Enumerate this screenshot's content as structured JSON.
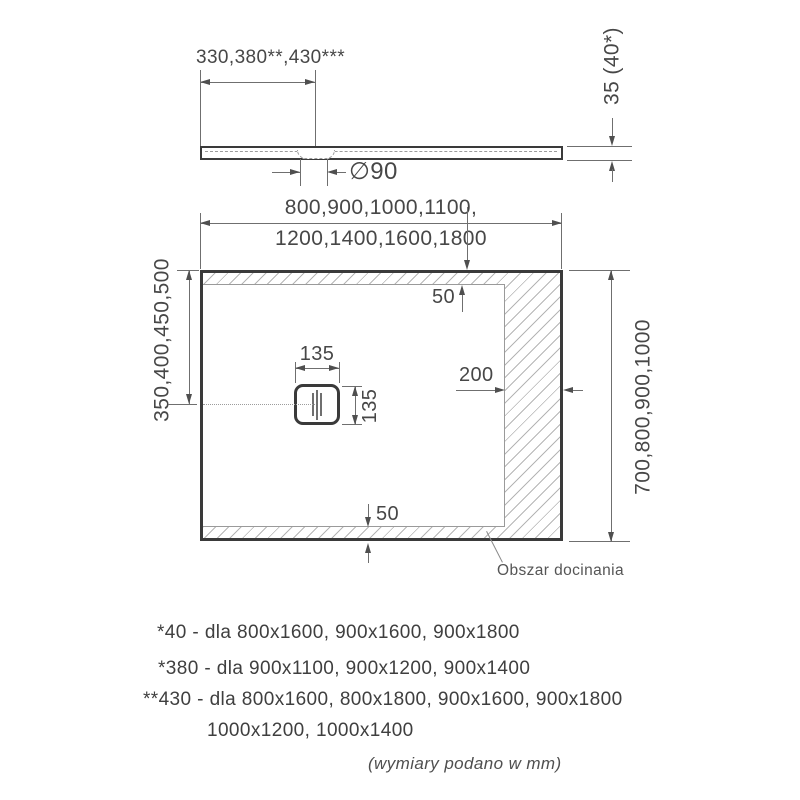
{
  "side_view": {
    "drain_offset_label": "330,380**,430***",
    "drain_diameter_label": "∅90",
    "thickness_label": "35 (40*)"
  },
  "top_view": {
    "width_label_line1": "800,900,1000,1100,",
    "width_label_line2": "1200,1400,1600,1800",
    "height_label": "700,800,900,1000",
    "drain_center_from_edge_label": "350,400,450,500",
    "top_margin_label": "50",
    "bottom_margin_label": "50",
    "right_margin_label": "200",
    "drain_width_label": "135",
    "drain_height_label": "135",
    "trim_area_label": "Obszar docinania"
  },
  "footnotes": {
    "line1": "*40 - dla 800x1600, 900x1600, 900x1800",
    "line2": "*380 - dla 900x1100, 900x1200, 900x1400",
    "line3": "**430 - dla 800x1600, 800x1800, 900x1600, 900x1800",
    "line4": "1000x1200, 1000x1400",
    "units_note": "(wymiary podano w mm)"
  },
  "colors": {
    "background": "#ffffff",
    "outline": "#3a3a3a",
    "dimension_lines": "#6f6f6f",
    "hatch": "#b5b5b5",
    "text": "#474747"
  }
}
